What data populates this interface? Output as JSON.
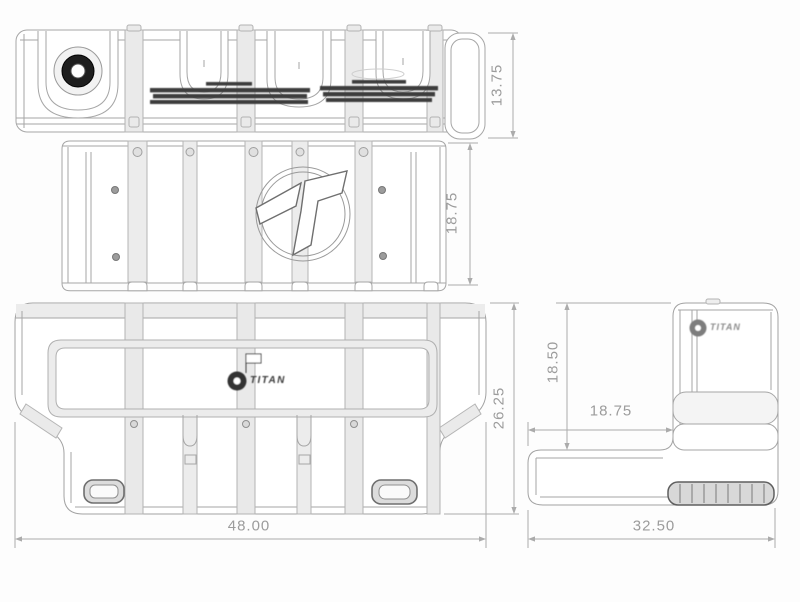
{
  "page": {
    "background": "#fdfdfd"
  },
  "drawing": {
    "type": "orthographic-technical-drawing",
    "subject": "transfer-tank",
    "line_color": "#a6a6a6",
    "accent_dark": "#2f2f2f",
    "views": [
      {
        "id": "top-view"
      },
      {
        "id": "front-view"
      },
      {
        "id": "bottom-view"
      },
      {
        "id": "side-view"
      }
    ],
    "dimensions": {
      "top_height": "13.75",
      "front_height": "18.75",
      "bottom_depth": "26.25",
      "bottom_width": "48.00",
      "side_height": "18.50",
      "side_leg": "18.75",
      "side_width": "32.50"
    },
    "logos": {
      "bottom_text": "TITAN",
      "side_text": "TITAN"
    }
  }
}
